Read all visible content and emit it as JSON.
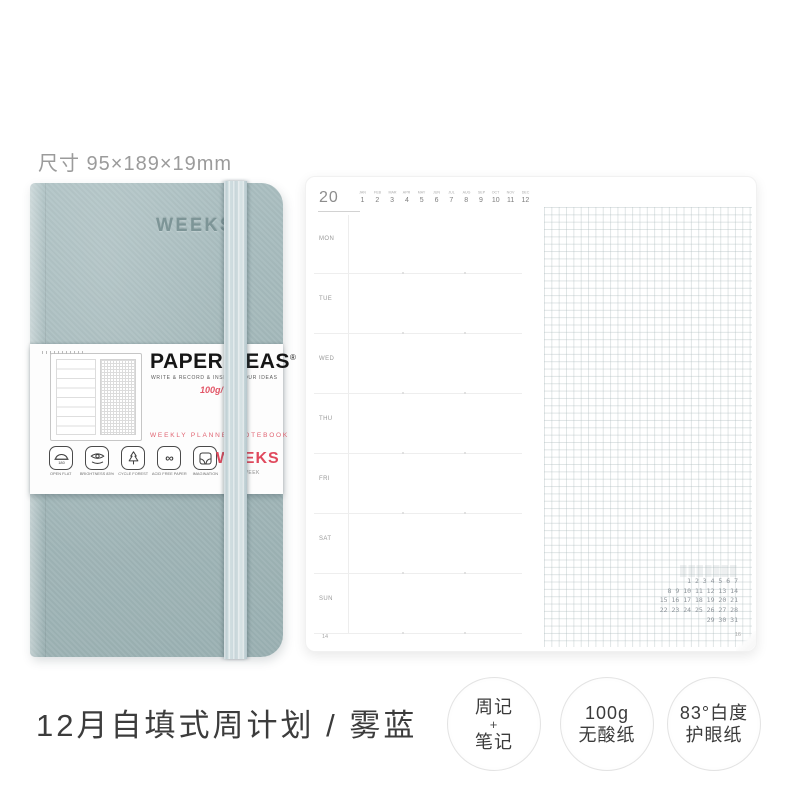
{
  "size_label": "尺寸 95×189×19mm",
  "notebook": {
    "cover_text": "WEEKS",
    "band": {
      "brand": "PAPERIDEAS",
      "reg_mark": "®",
      "tagline": "WRITE & RECORD & INSPIRE YOUR IDEAS",
      "paper_weight": "100g/㎡*",
      "product_line": "WEEKLY PLANNER NOTEBOOK",
      "weeks_label": "WEEKS",
      "weeks_sub": "1 WEEK",
      "features": [
        {
          "icon": "open-flat-icon",
          "label": "OPEN FLAT",
          "icon_text": "180"
        },
        {
          "icon": "brightness-icon",
          "label": "BRIGHTNESS 83%"
        },
        {
          "icon": "cycle-forest-icon",
          "label": "CYCLE FOREST"
        },
        {
          "icon": "acid-free-icon",
          "label": "ACID FREE PAPER",
          "icon_text": "∞"
        },
        {
          "icon": "imagination-icon",
          "label": "IMAGINATION"
        }
      ]
    }
  },
  "planner": {
    "year_prefix": "20",
    "months": [
      {
        "abbr": "JAN",
        "num": "1"
      },
      {
        "abbr": "FEB",
        "num": "2"
      },
      {
        "abbr": "MAR",
        "num": "3"
      },
      {
        "abbr": "APR",
        "num": "4"
      },
      {
        "abbr": "MAY",
        "num": "5"
      },
      {
        "abbr": "JUN",
        "num": "6"
      },
      {
        "abbr": "JUL",
        "num": "7"
      },
      {
        "abbr": "AUG",
        "num": "8"
      },
      {
        "abbr": "SEP",
        "num": "9"
      },
      {
        "abbr": "OCT",
        "num": "10"
      },
      {
        "abbr": "NOV",
        "num": "11"
      },
      {
        "abbr": "DEC",
        "num": "12"
      }
    ],
    "days": [
      "MON",
      "TUE",
      "WED",
      "THU",
      "FRI",
      "SAT",
      "SUN"
    ],
    "mini_calendar_rows": [
      "1 2 3 4 5 6 7",
      "8 9 10 11 12 13 14",
      "15 16 17 18 19 20 21",
      "22 23 24 25 26 27 28",
      "29 30 31"
    ],
    "page_number_left": "14",
    "page_number_right": "16"
  },
  "caption": "12月自填式周计划 / 雾蓝",
  "badges": [
    {
      "lines": [
        "周记",
        "+",
        "笔记"
      ]
    },
    {
      "lines": [
        "100g",
        "无酸纸"
      ]
    },
    {
      "lines": [
        "83°白度",
        "护眼纸"
      ]
    }
  ],
  "colors": {
    "cover": "#a3b8ba",
    "elastic": "#c9d8db",
    "accent_red": "#e0495d",
    "caption_text": "#3c3c3c",
    "muted_text": "#9b9b9b"
  }
}
